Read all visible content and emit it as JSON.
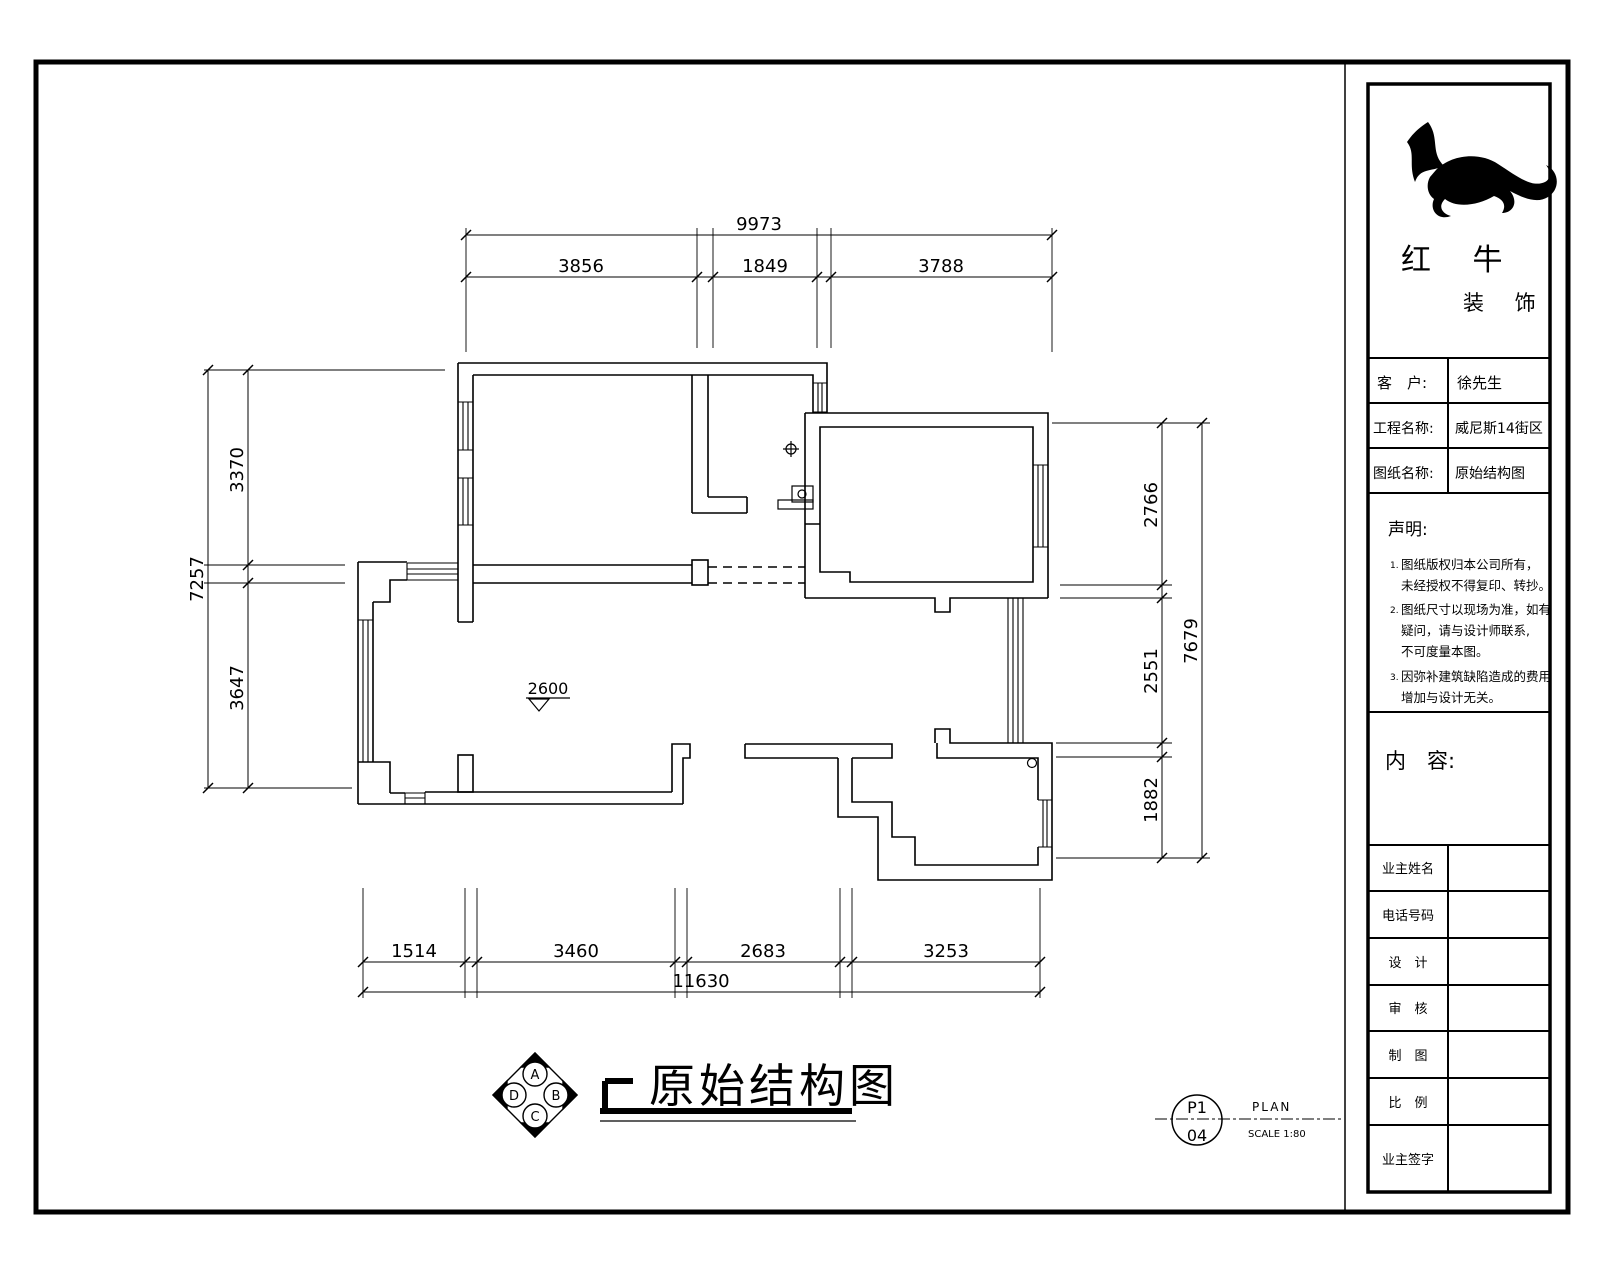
{
  "drawing_title": "原始结构图",
  "level_marker": "2600",
  "dimensions": {
    "top": {
      "overall": "9973",
      "seg1": "3856",
      "seg2": "1849",
      "seg3": "3788"
    },
    "left": {
      "overall": "7257",
      "seg1": "3370",
      "seg2": "3647"
    },
    "right": {
      "overall": "7679",
      "seg1": "2766",
      "seg2": "2551",
      "seg3": "1882"
    },
    "bottom": {
      "overall": "11630",
      "seg1": "1514",
      "seg2": "3460",
      "seg3": "2683",
      "seg4": "3253"
    }
  },
  "compass": {
    "top": "A",
    "right": "B",
    "bottom": "C",
    "left": "D"
  },
  "stamp": {
    "code_top": "P1",
    "code_bottom": "04",
    "plan_label": "PLAN",
    "scale_label": "SCALE 1:80"
  },
  "title_block": {
    "brand_line1": "红 牛",
    "brand_line2": "装 饰",
    "client_label": "客　户:",
    "client_value": "徐先生",
    "project_label": "工程名称:",
    "project_value": "威尼斯14街区",
    "drawing_label": "图纸名称:",
    "drawing_value": "原始结构图",
    "statement_title": "声明:",
    "note1_no": "1.",
    "note1_line1": "图纸版权归本公司所有，",
    "note1_line2": "未经授权不得复印、转抄。",
    "note2_no": "2.",
    "note2_line1": "图纸尺寸以现场为准，如有",
    "note2_line2": "疑问，请与设计师联系,",
    "note2_line3": "不可度量本图。",
    "note3_no": "3.",
    "note3_line1": "因弥补建筑缺陷造成的费用",
    "note3_line2": "增加与设计无关。",
    "content_label": "内　容:",
    "sign_rows": [
      {
        "label": "业主姓名"
      },
      {
        "label": "电话号码"
      },
      {
        "label": "设　计"
      },
      {
        "label": "审　核"
      },
      {
        "label": "制　图"
      },
      {
        "label": "比　例"
      },
      {
        "label": "业主签字"
      }
    ]
  }
}
